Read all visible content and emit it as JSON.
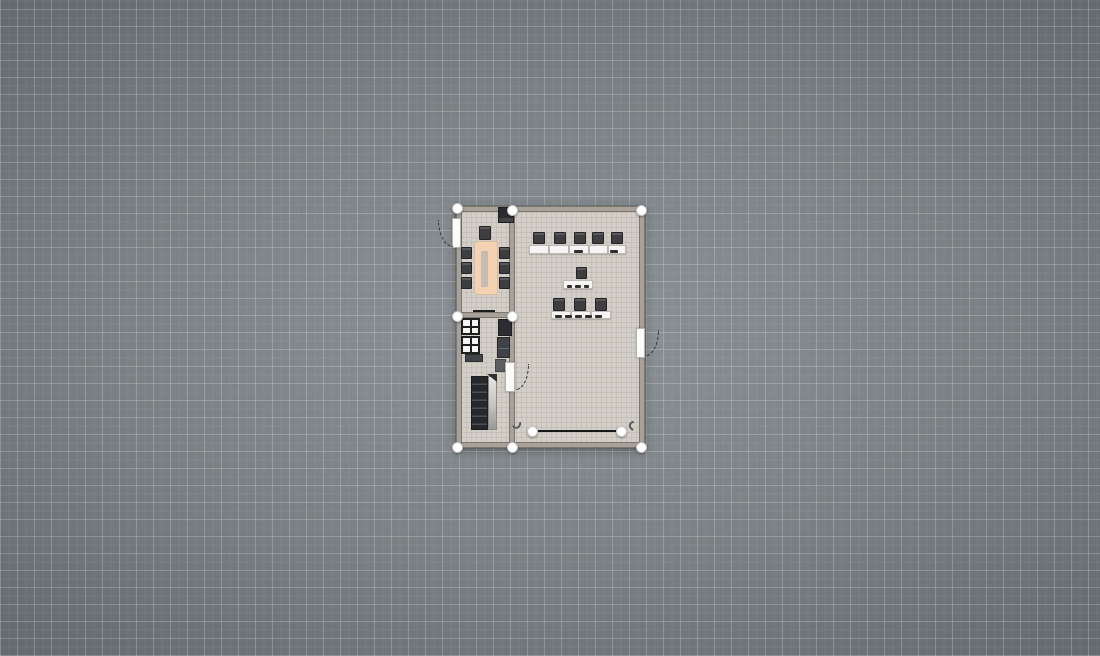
{
  "app": {
    "view": "floor-plan-2d-canvas"
  },
  "colors": {
    "canvas_center": "#8c9296",
    "canvas_edge": "#596064",
    "grid_line": "#ffffff",
    "floor": "#d3cfc8",
    "wall": "#a7a199",
    "furniture_dark": "#3e3e41",
    "desk_white": "#f6f5f3",
    "dining_table": "#f2d2b3",
    "handle": "#ffffff",
    "selection_line": "#181818"
  },
  "grid": {
    "major_px": 17,
    "minor_px": 8.5
  },
  "plan": {
    "bounds": {
      "x": 456,
      "y": 206,
      "w": 189,
      "h": 242
    },
    "rooms": [
      "dining-room",
      "kitchen",
      "classroom"
    ],
    "items": [
      {
        "kind": "floor",
        "name": "building-floor",
        "interactable": true,
        "x": 456,
        "y": 206,
        "w": 189,
        "h": 242
      },
      {
        "kind": "wall",
        "name": "wall-top",
        "interactable": true,
        "x": 456,
        "y": 206,
        "w": 189,
        "h": 6
      },
      {
        "kind": "wall",
        "name": "wall-bottom",
        "interactable": true,
        "x": 456,
        "y": 442,
        "w": 189,
        "h": 6
      },
      {
        "kind": "wall",
        "name": "wall-left",
        "interactable": true,
        "x": 456,
        "y": 206,
        "w": 6,
        "h": 242
      },
      {
        "kind": "wall",
        "name": "wall-right",
        "interactable": true,
        "x": 639,
        "y": 206,
        "w": 6,
        "h": 242
      },
      {
        "kind": "wall",
        "name": "wall-center-vertical",
        "interactable": true,
        "x": 509,
        "y": 206,
        "w": 6,
        "h": 242
      },
      {
        "kind": "wall",
        "name": "wall-left-divider",
        "interactable": true,
        "x": 456,
        "y": 312,
        "w": 59,
        "h": 6
      },
      {
        "kind": "fireplace",
        "name": "fireplace",
        "interactable": true,
        "x": 498,
        "y": 207,
        "w": 16,
        "h": 16
      },
      {
        "kind": "chair",
        "name": "dining-chair-head",
        "interactable": true,
        "x": 479,
        "y": 226,
        "w": 12,
        "h": 14
      },
      {
        "kind": "table",
        "name": "dining-table",
        "interactable": true,
        "x": 474,
        "y": 241,
        "w": 24,
        "h": 54
      },
      {
        "kind": "runner",
        "name": "table-runner",
        "interactable": false,
        "x": 481,
        "y": 251,
        "w": 7,
        "h": 36
      },
      {
        "kind": "chair",
        "name": "dining-chair-left-1",
        "interactable": true,
        "x": 461,
        "y": 247,
        "w": 11,
        "h": 12
      },
      {
        "kind": "chair",
        "name": "dining-chair-left-2",
        "interactable": true,
        "x": 461,
        "y": 262,
        "w": 11,
        "h": 12
      },
      {
        "kind": "chair",
        "name": "dining-chair-left-3",
        "interactable": true,
        "x": 461,
        "y": 277,
        "w": 11,
        "h": 12
      },
      {
        "kind": "chair",
        "name": "dining-chair-right-1",
        "interactable": true,
        "x": 499,
        "y": 247,
        "w": 11,
        "h": 12
      },
      {
        "kind": "chair",
        "name": "dining-chair-right-2",
        "interactable": true,
        "x": 499,
        "y": 262,
        "w": 11,
        "h": 12
      },
      {
        "kind": "chair",
        "name": "dining-chair-right-3",
        "interactable": true,
        "x": 499,
        "y": 277,
        "w": 11,
        "h": 12
      },
      {
        "kind": "line-dark",
        "name": "pass-through-counter",
        "interactable": true,
        "x": 473,
        "y": 310,
        "w": 22,
        "h": 2
      },
      {
        "kind": "window-cabinet",
        "name": "glass-cabinet-1",
        "interactable": true,
        "x": 461,
        "y": 318,
        "w": 19,
        "h": 17
      },
      {
        "kind": "window-cabinet",
        "name": "glass-cabinet-2",
        "interactable": true,
        "x": 461,
        "y": 336,
        "w": 19,
        "h": 18
      },
      {
        "kind": "corner-cabinet",
        "name": "corner-cabinet",
        "interactable": true,
        "x": 498,
        "y": 319,
        "w": 14,
        "h": 17
      },
      {
        "kind": "cabinet",
        "name": "kitchen-cabinet",
        "interactable": true,
        "x": 497,
        "y": 337,
        "w": 13,
        "h": 21
      },
      {
        "kind": "cabinet-light",
        "name": "kitchen-cabinet-light",
        "interactable": true,
        "x": 495,
        "y": 359,
        "w": 11,
        "h": 13
      },
      {
        "kind": "low-cabinet",
        "name": "low-cabinet",
        "interactable": true,
        "x": 465,
        "y": 354,
        "w": 18,
        "h": 8
      },
      {
        "kind": "shelf-dark",
        "name": "shelf-unit-dark",
        "interactable": true,
        "x": 471,
        "y": 376,
        "w": 17,
        "h": 54
      },
      {
        "kind": "shelf-light",
        "name": "shelf-unit-door",
        "interactable": true,
        "x": 488,
        "y": 376,
        "w": 9,
        "h": 54
      },
      {
        "kind": "wedge",
        "name": "shelf-unit-corner",
        "interactable": false,
        "x": 487,
        "y": 374,
        "w": 10,
        "h": 8
      },
      {
        "kind": "chair",
        "name": "classroom-chair-row1-1",
        "interactable": true,
        "x": 533,
        "y": 232,
        "w": 12,
        "h": 12
      },
      {
        "kind": "chair",
        "name": "classroom-chair-row1-2",
        "interactable": true,
        "x": 554,
        "y": 232,
        "w": 12,
        "h": 12
      },
      {
        "kind": "chair",
        "name": "classroom-chair-row1-3",
        "interactable": true,
        "x": 574,
        "y": 232,
        "w": 12,
        "h": 12
      },
      {
        "kind": "chair",
        "name": "classroom-chair-row1-4",
        "interactable": true,
        "x": 592,
        "y": 232,
        "w": 12,
        "h": 12
      },
      {
        "kind": "chair",
        "name": "classroom-chair-row1-5",
        "interactable": true,
        "x": 611,
        "y": 232,
        "w": 12,
        "h": 12
      },
      {
        "kind": "desk",
        "name": "student-desk-row1-1",
        "interactable": true,
        "x": 529,
        "y": 245,
        "w": 20,
        "h": 9
      },
      {
        "kind": "desk",
        "name": "student-desk-row1-2",
        "interactable": true,
        "x": 549,
        "y": 245,
        "w": 20,
        "h": 9
      },
      {
        "kind": "desk",
        "name": "student-desk-row1-3",
        "interactable": true,
        "x": 569,
        "y": 245,
        "w": 20,
        "h": 9
      },
      {
        "kind": "desk",
        "name": "student-desk-row1-4",
        "interactable": true,
        "x": 589,
        "y": 245,
        "w": 19,
        "h": 9
      },
      {
        "kind": "desk",
        "name": "student-desk-row1-5",
        "interactable": true,
        "x": 608,
        "y": 245,
        "w": 18,
        "h": 9
      },
      {
        "kind": "mark",
        "name": "desk-item",
        "interactable": false,
        "x": 574,
        "y": 250,
        "w": 9,
        "h": 3
      },
      {
        "kind": "mark",
        "name": "desk-item",
        "interactable": false,
        "x": 610,
        "y": 250,
        "w": 8,
        "h": 3
      },
      {
        "kind": "chair",
        "name": "teacher-chair",
        "interactable": true,
        "x": 576,
        "y": 267,
        "w": 11,
        "h": 12
      },
      {
        "kind": "desk",
        "name": "teacher-desk",
        "interactable": true,
        "x": 563,
        "y": 280,
        "w": 30,
        "h": 9
      },
      {
        "kind": "mark",
        "name": "desk-item",
        "interactable": false,
        "x": 567,
        "y": 285,
        "w": 5,
        "h": 3
      },
      {
        "kind": "mark",
        "name": "desk-item",
        "interactable": false,
        "x": 575,
        "y": 285,
        "w": 6,
        "h": 3
      },
      {
        "kind": "mark",
        "name": "desk-item",
        "interactable": false,
        "x": 584,
        "y": 285,
        "w": 5,
        "h": 3
      },
      {
        "kind": "chair",
        "name": "classroom-chair-row2-1",
        "interactable": true,
        "x": 553,
        "y": 298,
        "w": 12,
        "h": 13
      },
      {
        "kind": "chair",
        "name": "classroom-chair-row2-2",
        "interactable": true,
        "x": 574,
        "y": 298,
        "w": 12,
        "h": 13
      },
      {
        "kind": "chair",
        "name": "classroom-chair-row2-3",
        "interactable": true,
        "x": 595,
        "y": 298,
        "w": 12,
        "h": 13
      },
      {
        "kind": "desk",
        "name": "student-desk-row2-1",
        "interactable": true,
        "x": 551,
        "y": 311,
        "w": 20,
        "h": 8
      },
      {
        "kind": "desk",
        "name": "student-desk-row2-2",
        "interactable": true,
        "x": 571,
        "y": 311,
        "w": 20,
        "h": 8
      },
      {
        "kind": "desk",
        "name": "student-desk-row2-3",
        "interactable": true,
        "x": 591,
        "y": 311,
        "w": 20,
        "h": 8
      },
      {
        "kind": "mark",
        "name": "desk-item",
        "interactable": false,
        "x": 555,
        "y": 315,
        "w": 7,
        "h": 3
      },
      {
        "kind": "mark",
        "name": "desk-item",
        "interactable": false,
        "x": 565,
        "y": 315,
        "w": 7,
        "h": 3
      },
      {
        "kind": "mark",
        "name": "desk-item",
        "interactable": false,
        "x": 575,
        "y": 315,
        "w": 7,
        "h": 3
      },
      {
        "kind": "mark",
        "name": "desk-item",
        "interactable": false,
        "x": 585,
        "y": 315,
        "w": 7,
        "h": 3
      },
      {
        "kind": "mark",
        "name": "desk-item",
        "interactable": false,
        "x": 595,
        "y": 315,
        "w": 7,
        "h": 3
      },
      {
        "kind": "door-leaf",
        "name": "door-west",
        "interactable": true,
        "x": 452,
        "y": 218,
        "w": 9,
        "h": 30
      },
      {
        "kind": "door-arc-bl",
        "name": "door-west-swing-arc",
        "interactable": false,
        "x": 438,
        "y": 220,
        "w": 15,
        "h": 27
      },
      {
        "kind": "door-leaf",
        "name": "door-east",
        "interactable": true,
        "x": 636,
        "y": 328,
        "w": 9,
        "h": 30
      },
      {
        "kind": "door-arc-br",
        "name": "door-east-swing-arc",
        "interactable": false,
        "x": 646,
        "y": 330,
        "w": 13,
        "h": 26
      },
      {
        "kind": "door-leaf",
        "name": "door-center",
        "interactable": true,
        "x": 505,
        "y": 362,
        "w": 10,
        "h": 30
      },
      {
        "kind": "door-arc-br",
        "name": "door-center-swing-arc",
        "interactable": false,
        "x": 516,
        "y": 364,
        "w": 13,
        "h": 26
      },
      {
        "kind": "hook-l",
        "name": "wall-hook-left",
        "interactable": true,
        "x": 512,
        "y": 419,
        "w": 9,
        "h": 10
      },
      {
        "kind": "hook-r",
        "name": "wall-hook-right",
        "interactable": true,
        "x": 629,
        "y": 421,
        "w": 9,
        "h": 10
      },
      {
        "kind": "selection-line",
        "name": "selected-wall-segment",
        "interactable": true,
        "x": 532,
        "y": 430,
        "w": 89,
        "h": 2
      },
      {
        "kind": "handle",
        "name": "wall-handle-top-left",
        "interactable": true,
        "x": 451.5,
        "y": 202.5,
        "w": 11,
        "h": 11
      },
      {
        "kind": "handle",
        "name": "wall-handle-top-middle",
        "interactable": true,
        "x": 506.5,
        "y": 204.5,
        "w": 11,
        "h": 11
      },
      {
        "kind": "handle",
        "name": "wall-handle-top-right",
        "interactable": true,
        "x": 635.5,
        "y": 204.5,
        "w": 11,
        "h": 11
      },
      {
        "kind": "handle",
        "name": "wall-handle-mid-left",
        "interactable": true,
        "x": 451.5,
        "y": 310.5,
        "w": 11,
        "h": 11
      },
      {
        "kind": "handle",
        "name": "wall-handle-mid-center",
        "interactable": true,
        "x": 506.5,
        "y": 310.5,
        "w": 11,
        "h": 11
      },
      {
        "kind": "handle",
        "name": "wall-handle-bottom-left",
        "interactable": true,
        "x": 451.5,
        "y": 441.5,
        "w": 11,
        "h": 11
      },
      {
        "kind": "handle",
        "name": "wall-handle-bottom-middle",
        "interactable": true,
        "x": 506.5,
        "y": 441.5,
        "w": 11,
        "h": 11
      },
      {
        "kind": "handle",
        "name": "wall-handle-bottom-right",
        "interactable": true,
        "x": 635.5,
        "y": 441.5,
        "w": 11,
        "h": 11
      },
      {
        "kind": "handle",
        "name": "segment-handle-left",
        "interactable": true,
        "x": 526.5,
        "y": 425.5,
        "w": 11,
        "h": 11
      },
      {
        "kind": "handle",
        "name": "segment-handle-right",
        "interactable": true,
        "x": 615.5,
        "y": 425.5,
        "w": 11,
        "h": 11
      }
    ]
  }
}
